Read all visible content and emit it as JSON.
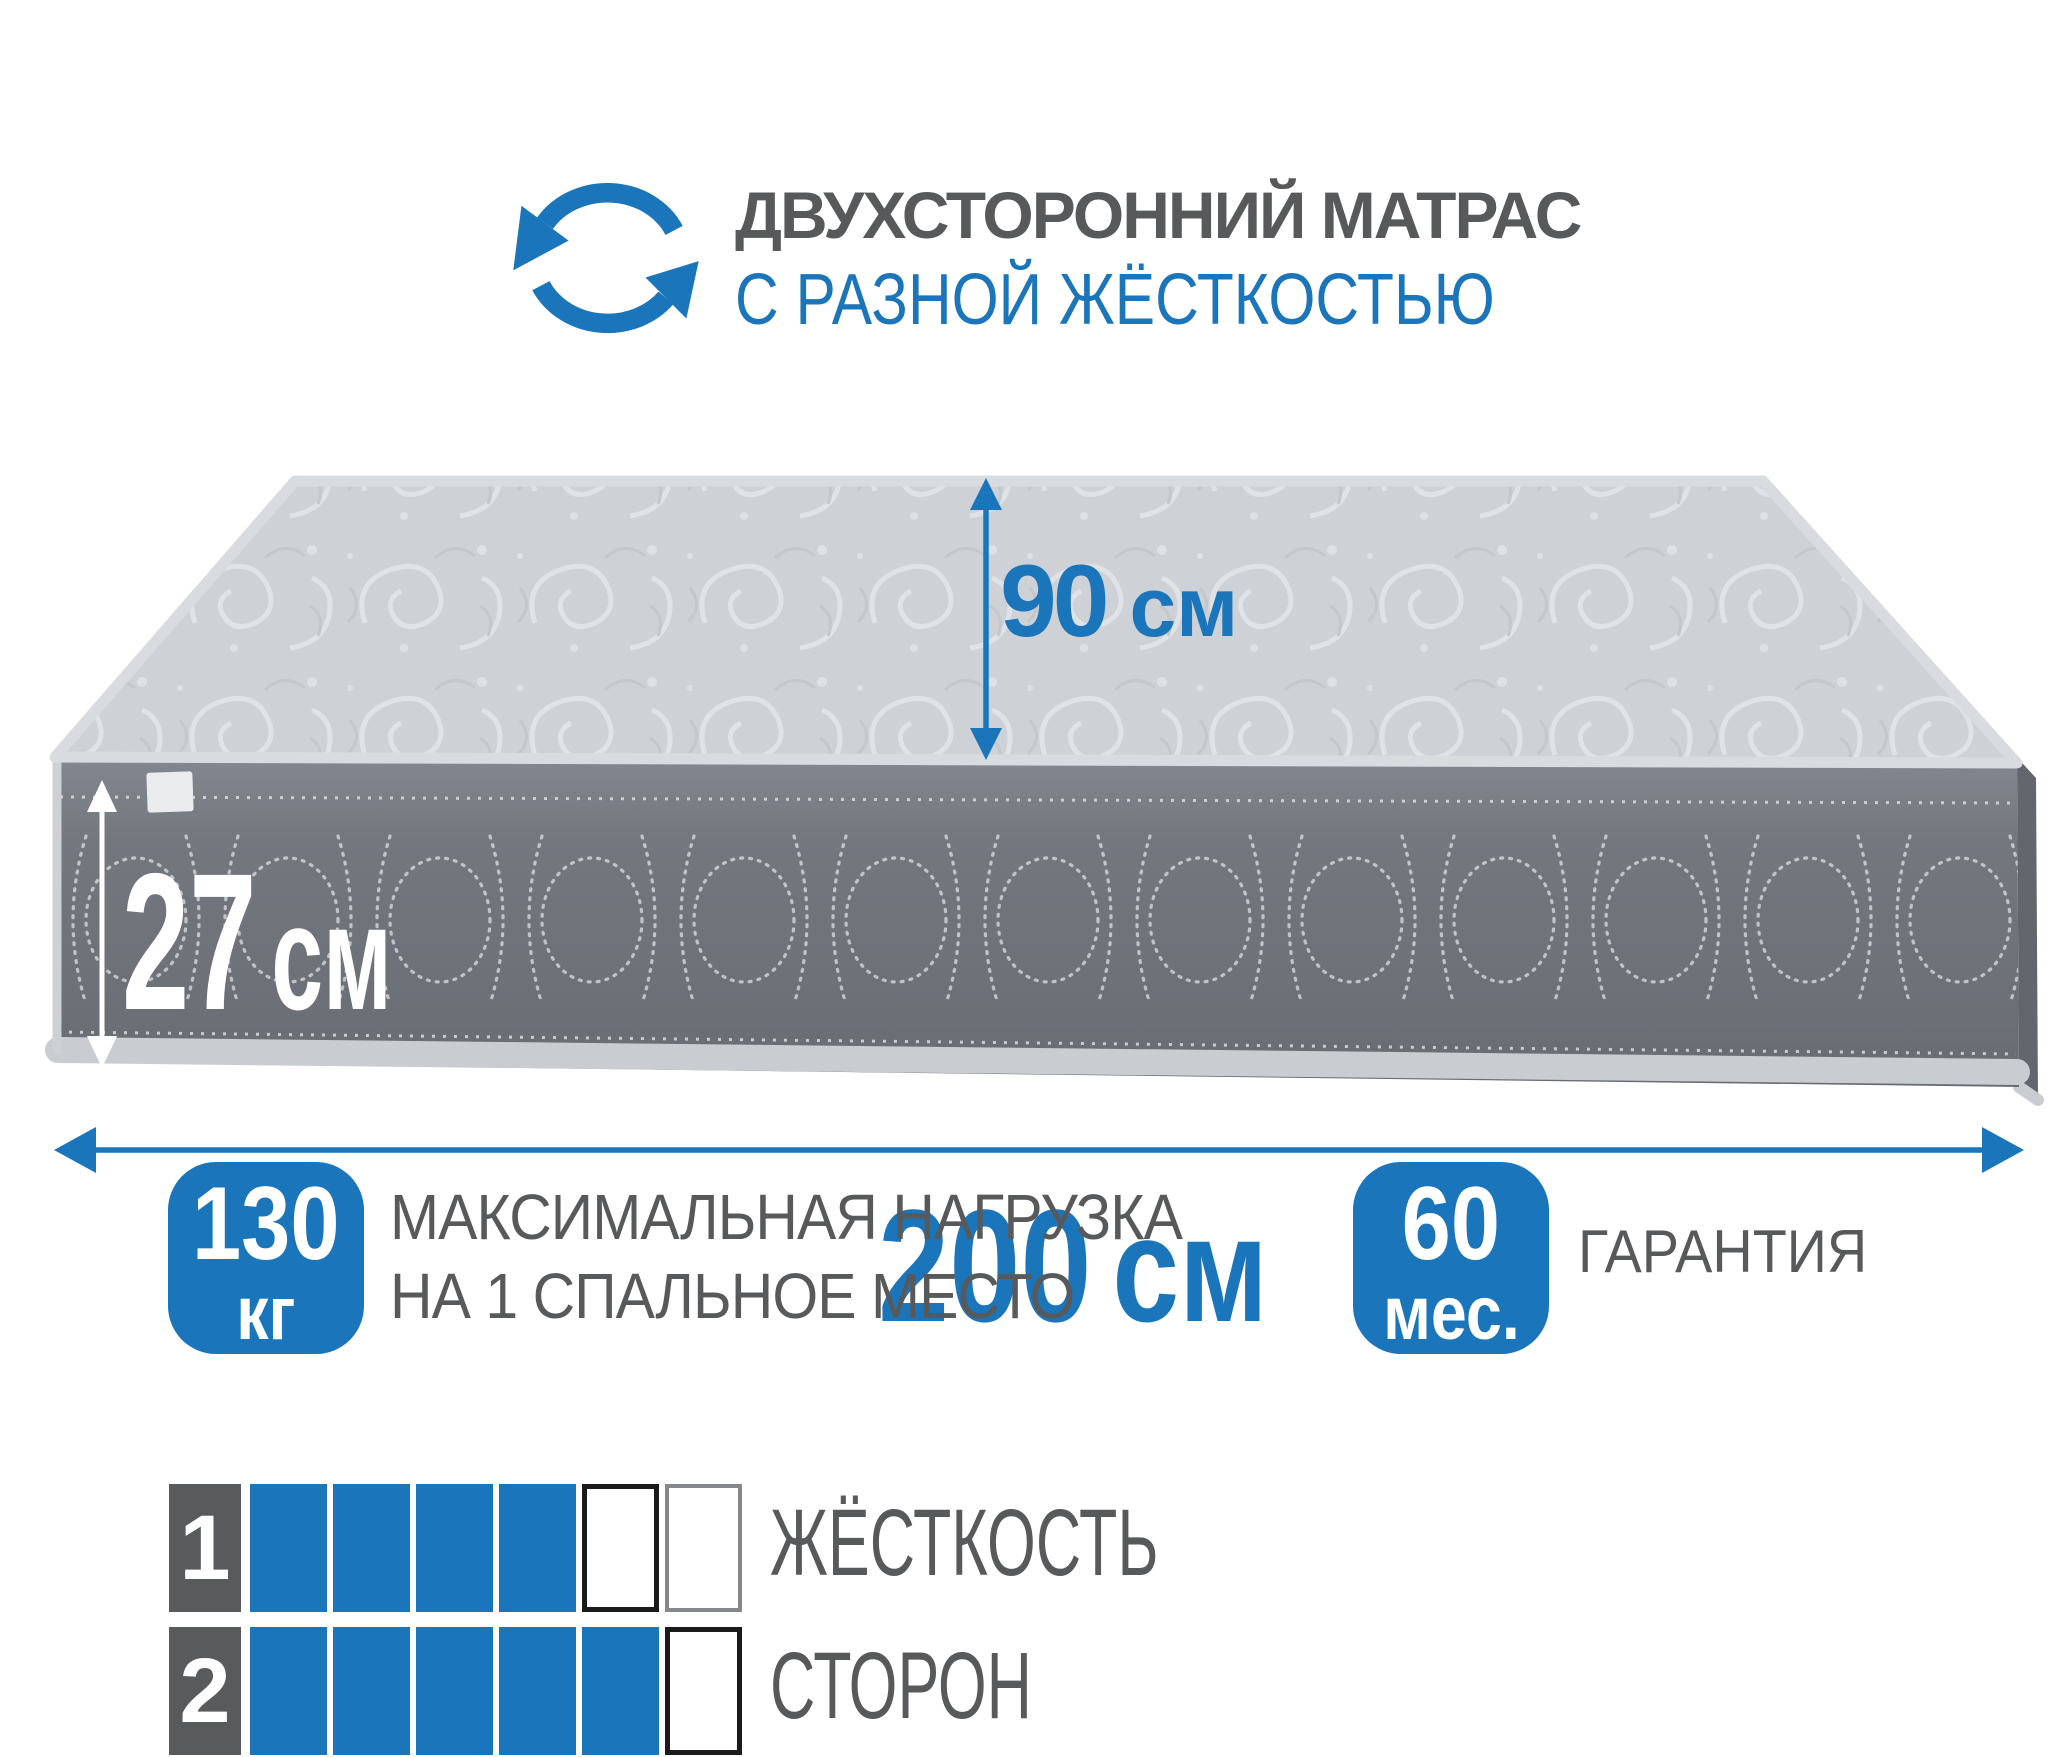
{
  "colors": {
    "accent_blue": "#1b75bb",
    "text_gray": "#58595b",
    "square_dark": "#595a5c",
    "empty_border_strong": "#1a1a1a",
    "empty_border_light": "#85878a"
  },
  "header": {
    "icon": "rotate-arrows-icon",
    "title": "ДВУХСТОРОННИЙ МАТРАС",
    "subtitle": "С РАЗНОЙ ЖЁСТКОСТЬЮ"
  },
  "mattress": {
    "height_label": {
      "value": "90",
      "unit": "см"
    },
    "thickness_label": {
      "value": "27",
      "unit": "см"
    },
    "length_label": {
      "value": "200",
      "unit": "см"
    }
  },
  "badges": {
    "max_load": {
      "value": "130",
      "unit": "кг",
      "line1": "МАКСИМАЛЬНАЯ НАГРУЗКА",
      "line2": "НА 1 СПАЛЬНОЕ МЕСТО"
    },
    "warranty": {
      "value": "60",
      "unit": "мес.",
      "label": "ГАРАНТИЯ"
    }
  },
  "firmness": {
    "title_line1": "ЖЁСТКОСТЬ",
    "title_line2": "СТОРОН",
    "rows": [
      {
        "index": "1",
        "cells": [
          "filled",
          "filled",
          "filled",
          "filled",
          "empty-strong",
          "empty-light"
        ]
      },
      {
        "index": "2",
        "cells": [
          "filled",
          "filled",
          "filled",
          "filled",
          "filled",
          "empty-strong"
        ]
      }
    ]
  }
}
